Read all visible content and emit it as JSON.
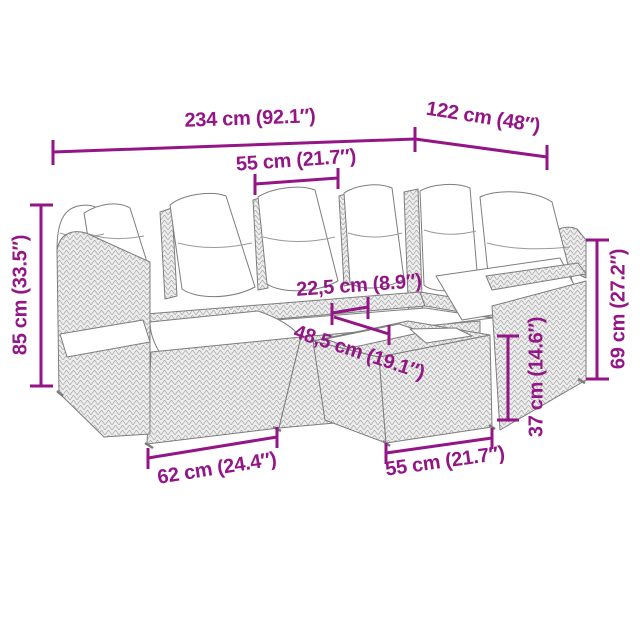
{
  "canvas": {
    "width": 640,
    "height": 640,
    "background": "#ffffff"
  },
  "style": {
    "dimension_color": "#931586",
    "outline_color": "#7d7d7d",
    "texture_line_color": "#a9a9a9",
    "texture_fill": "#ededed",
    "cushion_color": "#ffffff"
  },
  "drawing": {
    "subject": "rattan-corner-sofa-set-with-cushions-and-table-line-drawing"
  },
  "dimensions": {
    "total_width": {
      "label": "234 cm (92.1″)",
      "value_cm": "234",
      "value_in": "92.1"
    },
    "total_depth": {
      "label": "122 cm (48″)",
      "value_cm": "122",
      "value_in": "48"
    },
    "seat_width": {
      "label": "55 cm (21.7″)",
      "value_cm": "55",
      "value_in": "21.7"
    },
    "back_height": {
      "label": "85 cm (33.5″)",
      "value_cm": "85",
      "value_in": "33.5"
    },
    "armrest_width": {
      "label": "22,5 cm (8.9″)",
      "value_cm": "22,5",
      "value_in": "8.9"
    },
    "seat_depth": {
      "label": "48,5 cm (19.1″)",
      "value_cm": "48,5",
      "value_in": "19.1"
    },
    "table_height": {
      "label": "37 cm (14.6″)",
      "value_cm": "37",
      "value_in": "14.6"
    },
    "arm_height": {
      "label": "69 cm (27.2″)",
      "value_cm": "69",
      "value_in": "27.2"
    },
    "module_width": {
      "label": "62 cm (24.4″)",
      "value_cm": "62",
      "value_in": "24.4"
    },
    "table_width": {
      "label": "55 cm (21.7″)",
      "value_cm": "55",
      "value_in": "21.7"
    }
  }
}
